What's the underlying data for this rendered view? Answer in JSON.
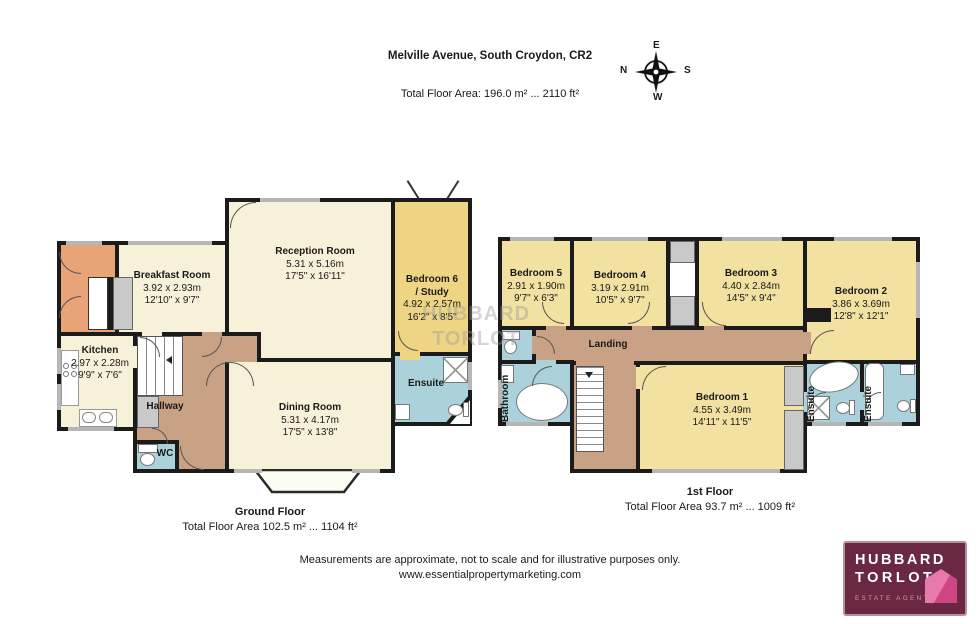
{
  "header": {
    "title": "Melville Avenue, South Croydon, CR2",
    "subtitle": "Total Floor Area: 196.0 m² ... 2110 ft²"
  },
  "compass": {
    "e": "E",
    "n": "N",
    "s": "S",
    "w": "W"
  },
  "watermark": {
    "line1": "HUBBARD",
    "line2": "TORLOT"
  },
  "ground": {
    "title": "Ground Floor",
    "area": "Total Floor Area 102.5 m² ... 1104 ft²",
    "rooms": {
      "breakfast": {
        "name": "Breakfast Room",
        "metric": "3.92 x 2.93m",
        "imperial": "12'10\" x 9'7\""
      },
      "reception": {
        "name": "Reception Room",
        "metric": "5.31 x 5.16m",
        "imperial": "17'5\" x 16'11\""
      },
      "bedroom6": {
        "name": "Bedroom 6",
        "name2": "/ Study",
        "metric": "4.92 x 2.57m",
        "imperial": "16'2\" x 8'5\""
      },
      "kitchen": {
        "name": "Kitchen",
        "metric": "2.97 x 2.28m",
        "imperial": "9'9\" x 7'6\""
      },
      "hallway": {
        "name": "Hallway"
      },
      "dining": {
        "name": "Dining Room",
        "metric": "5.31 x 4.17m",
        "imperial": "17'5\" x 13'8\""
      },
      "wc": {
        "name": "WC"
      },
      "ensuite": {
        "name": "Ensuite"
      }
    }
  },
  "first": {
    "title": "1st Floor",
    "area": "Total Floor Area 93.7 m² ... 1009 ft²",
    "rooms": {
      "bedroom5": {
        "name": "Bedroom 5",
        "metric": "2.91 x 1.90m",
        "imperial": "9'7\" x 6'3\""
      },
      "bedroom4": {
        "name": "Bedroom 4",
        "metric": "3.19 x 2.91m",
        "imperial": "10'5\" x 9'7\""
      },
      "bedroom3": {
        "name": "Bedroom 3",
        "metric": "4.40 x 2.84m",
        "imperial": "14'5\" x 9'4\""
      },
      "bedroom2": {
        "name": "Bedroom 2",
        "metric": "3.86 x 3.69m",
        "imperial": "12'8\" x 12'1\""
      },
      "bedroom1": {
        "name": "Bedroom 1",
        "metric": "4.55 x 3.49m",
        "imperial": "14'11\" x 11'5\""
      },
      "landing": {
        "name": "Landing"
      },
      "bathroom": {
        "name": "Bathroom"
      },
      "ensuiteA": {
        "name": "Ensuite"
      },
      "ensuiteB": {
        "name": "Ensuite"
      }
    }
  },
  "footer": {
    "line1": "Measurements are approximate, not to scale and for illustrative purposes only.",
    "line2": "www.essentialpropertymarketing.com"
  },
  "logo": {
    "name1": "HUBBARD",
    "name2": "TORLOT",
    "tagline": "ESTATE AGENTS"
  },
  "colors": {
    "wall": "#1b1b1b",
    "room_cream": "#f7f1d9",
    "room_gold": "#eed584",
    "room_gold_light": "#f2e1a1",
    "circulation_tan": "#c9a285",
    "entrance_orange": "#e8a377",
    "wet_room_blue": "#abd2da",
    "closet_gray": "#c9c9c9",
    "logo_maroon": "#6b2843",
    "logo_pink": "#df5290"
  }
}
